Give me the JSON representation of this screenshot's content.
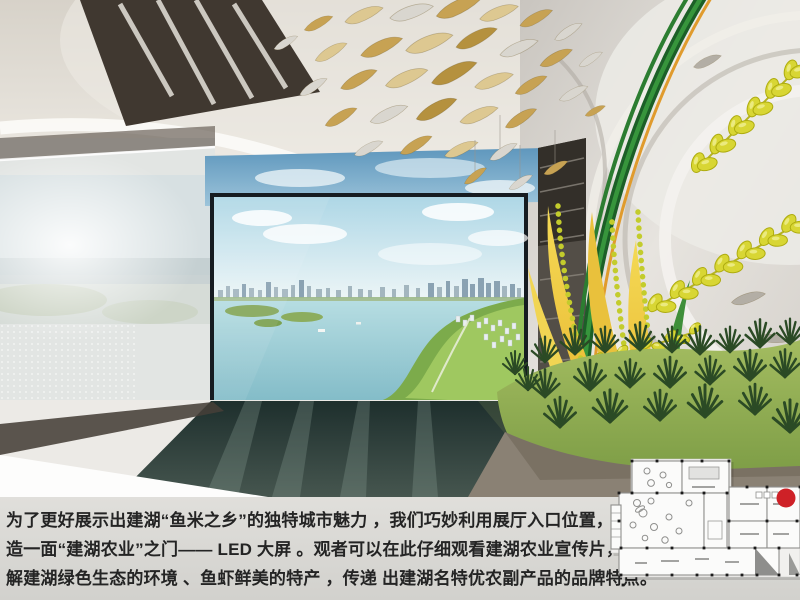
{
  "caption": {
    "lines": [
      "为了更好展示出建湖“鱼米之乡”的独特城市魅力 ，我们巧妙利用展厅入口位置，创新打",
      "造一面“建湖农业”之门—— LED 大屏 。观者可以在此仔细观看建湖农业宣传片，更好了",
      "解建湖绿色生态的环境 、鱼虾鲜美的特产 ，传递  出建湖名特优农副产品的品牌特点。"
    ]
  },
  "colors": {
    "marker_red": "#ce2127",
    "rice_yellow": "#d8d634",
    "stem_green": "#1c5f27",
    "water_blue": "#9fd0da",
    "caption_text": "#242424",
    "caption_bg": "#d8d7d3"
  },
  "floor_plan": {
    "marker_color": "#ce2127"
  }
}
